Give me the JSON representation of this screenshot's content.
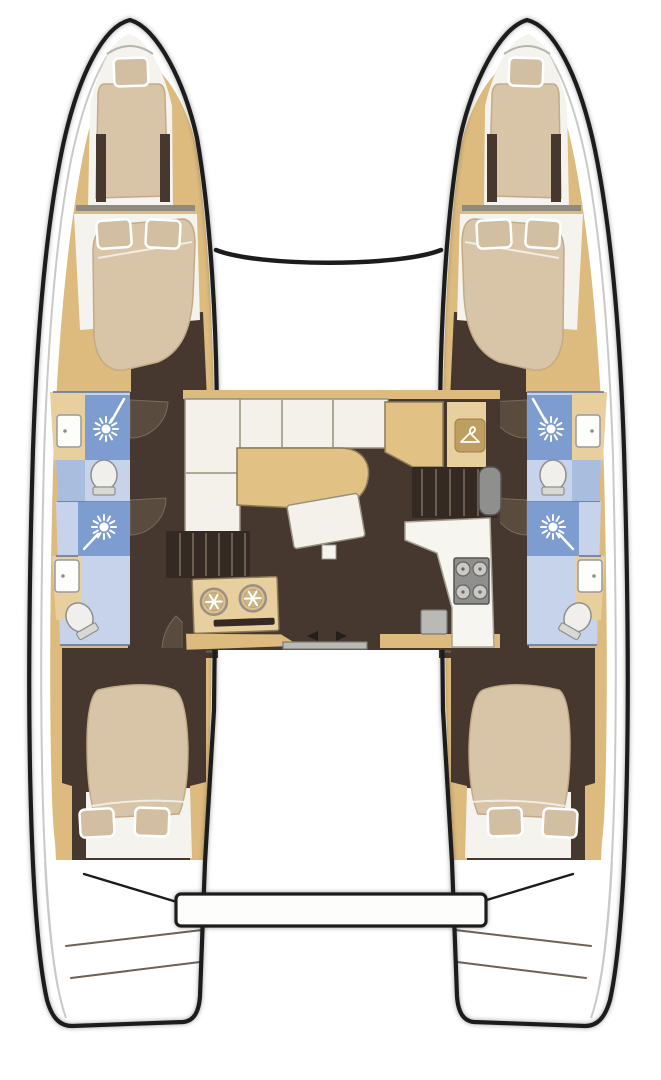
{
  "meta": {
    "description": "Top-down interior floor plan of a four-cabin sailing catamaran, bow pointing up",
    "visible_text": "none"
  },
  "colors": {
    "outline": "#1c1c1c",
    "deck": "#ffffff",
    "deck_shadow": "#c9c9c6",
    "wood": "#ddba7d",
    "wood_light": "#e8cf9e",
    "floor": "#46382f",
    "door_wedge": "#5a4b3f",
    "mattress": "#d8c4a7",
    "mattress_shadow": "#c3ab89",
    "pillow": "#d2bea1",
    "sheet": "#f5f3ed",
    "shower_blue": "#7d9cd0",
    "bath_blue": "#a9bddf",
    "bath_blue_light": "#c6d3ea",
    "porcelain": "#f0efec",
    "steel": "#b9b9b6",
    "counter_white": "#f6f5f0",
    "table": "#e2c184",
    "sofa": "#f3f1ea",
    "stove_gray": "#8f8f8d",
    "burner_gray": "#c9c9c6",
    "hanger_plate": "#bf9e62",
    "stairs_dark": "#352a23",
    "tread": "#6b5d50",
    "step_line": "#6e6156",
    "wall_blue": "#5b719c",
    "divider_gray": "#8f8a80",
    "arrow_dark": "#241e19"
  },
  "vessel": {
    "type": "catamaran",
    "orientation": "bow-up",
    "hulls": [
      {
        "side": "port",
        "position": "left",
        "spaces": [
          "bow-forepeak-berth",
          "forward-double-cabin",
          "forward-head-shower-sink-toilet",
          "aft-head-shower-sink-toilet",
          "aft-double-cabin",
          "transom-steps"
        ]
      },
      {
        "side": "starboard",
        "position": "right",
        "spaces": [
          "bow-forepeak-berth",
          "forward-double-cabin",
          "forward-head-shower-sink-toilet",
          "aft-head-shower-sink-toilet",
          "aft-double-cabin",
          "transom-steps"
        ]
      }
    ],
    "salon": {
      "features": [
        "l-shaped-sofa",
        "dining-table",
        "ottoman-seat",
        "forward-cabinet",
        "hanging-locker-hanger-icon",
        "galley-unit-two-round-basins",
        "four-burner-stove",
        "galley-sink",
        "port-companionway-steps",
        "starboard-companionway-steps",
        "sliding-door-to-cockpit"
      ]
    },
    "exterior": {
      "features": [
        "bow-trampoline-gap",
        "forward-crossbeam",
        "cockpit",
        "aft-platform",
        "transom-steps-both-hulls"
      ]
    }
  },
  "counts": {
    "cabins": 4,
    "heads": 4,
    "shower_icons": 4,
    "toilets": 4,
    "bathroom_sinks": 4,
    "stove_burners": 4,
    "round_basins": 2,
    "bed_pillows": 10
  }
}
